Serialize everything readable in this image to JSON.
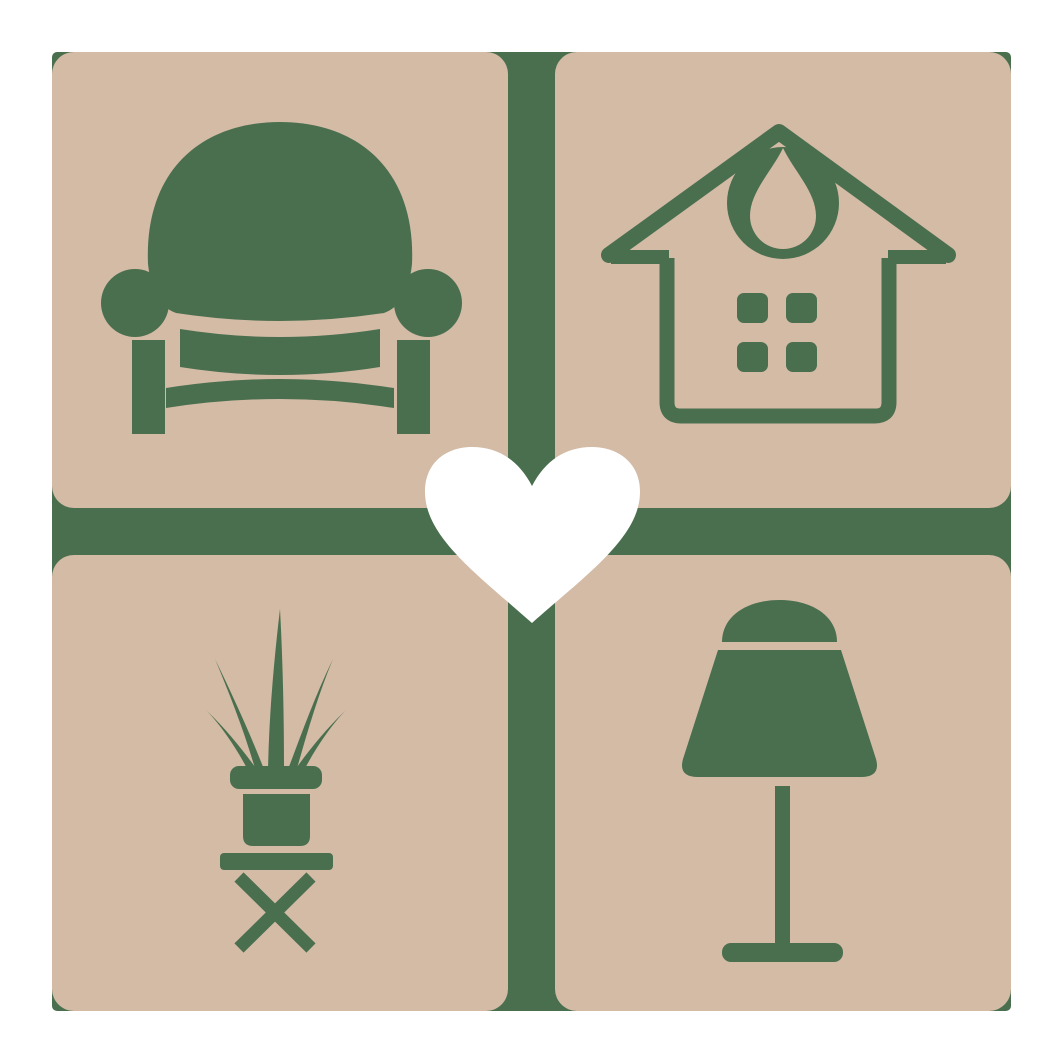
{
  "canvas": {
    "width_px": 1063,
    "height_px": 1063,
    "background": "#FFFFFF"
  },
  "logo": {
    "description": "home-furnishing-love-logo",
    "colors": {
      "tile": "#D3BBA6",
      "icon": "#4A6F4E",
      "divider": "#4A6F4E",
      "heart": "#FFFFFF",
      "canvas-bg": "#FFFFFF"
    },
    "grid": {
      "rows": 2,
      "cols": 2,
      "margin_px": 52,
      "tile_size_px": 456,
      "gap_px": 47,
      "tile_corner_radius_px": 22,
      "backdrop_corner_radius_px": 5
    },
    "tiles": [
      {
        "position": "top-left",
        "icon": "armchair"
      },
      {
        "position": "top-right",
        "icon": "house-with-window-and-pendant"
      },
      {
        "position": "bottom-left",
        "icon": "potted-plant-on-stool"
      },
      {
        "position": "bottom-right",
        "icon": "table-lamp"
      }
    ],
    "center_overlay": {
      "icon": "heart",
      "color": "#FFFFFF"
    }
  }
}
